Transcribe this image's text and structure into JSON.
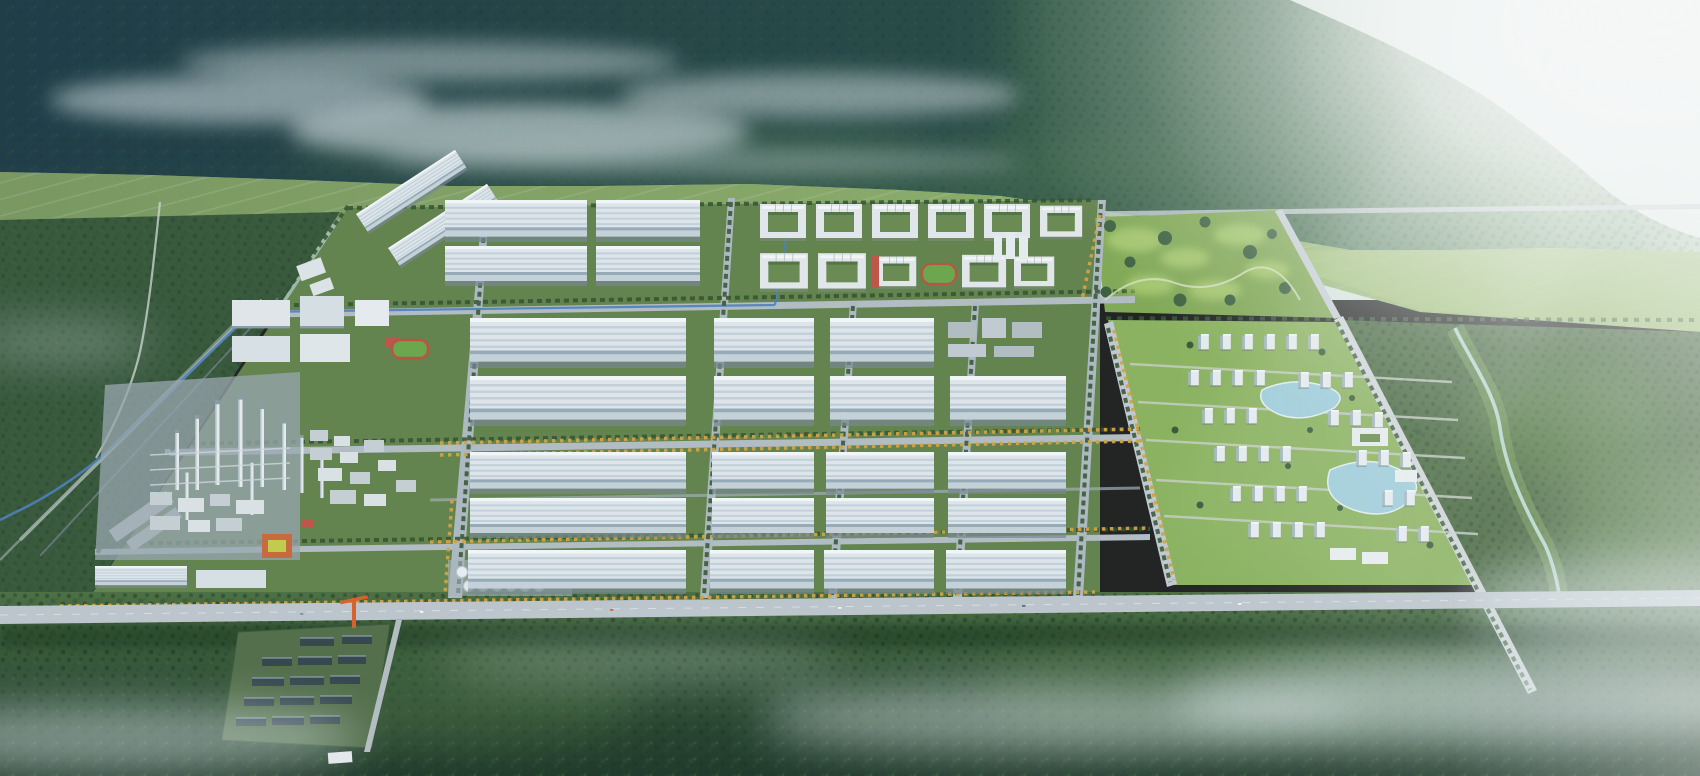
{
  "scene": {
    "kind": "aerial-3d-architectural-rendering",
    "subject": "industrial-park-masterplan-in-mountain-valley",
    "regions": [
      "mountain-range",
      "distant-haze-ridge",
      "clouds-mist",
      "sun-flare",
      "foothill-fields",
      "west-forest",
      "access-corridor",
      "canal",
      "industrial-park",
      "northwest-warehouses",
      "factory-plant",
      "chimneys",
      "storage-tanks",
      "central-warehouses",
      "campus-blocks",
      "sports-field",
      "golf-parkland",
      "residential-district",
      "lakes",
      "stream",
      "east-forest",
      "road-grid",
      "main-boulevard",
      "shed-compound",
      "tower-crane",
      "south-forest",
      "ground-mist"
    ]
  },
  "palette": {
    "mountain_teal": "#223f4a",
    "mountain_green": "#33574a",
    "far_haze": "#c9ddd2",
    "cloud": "#dfeaee",
    "foothill_field": "#8fb06c",
    "west_forest": "#3a5a3d",
    "east_forest": "#49693f",
    "park_ground": "#66854f",
    "road": "#b8c1c9",
    "boulevard": "#c3cbd2",
    "canal": "#4f83c0",
    "warehouse_roof": "#e6edf2",
    "warehouse_shadow": "#9bafbc",
    "campus_white": "#e9eef1",
    "courtyard_green": "#6d8f54",
    "accent_orange": "#cf6b3f",
    "accent_red": "#c4574a",
    "yellow_trees": "#d8a843",
    "tree_green": "#34532f",
    "lawn": "#8fb761",
    "lake": "#a3d2e0",
    "stream": "#bfe0d8",
    "forest_south": "#2f4f33",
    "shed_roof": "#37474f",
    "crane_orange": "#e0622d",
    "tank_white": "#f0f5f8",
    "mist": "#e3edf0",
    "sun_flare": "#ffffff"
  }
}
